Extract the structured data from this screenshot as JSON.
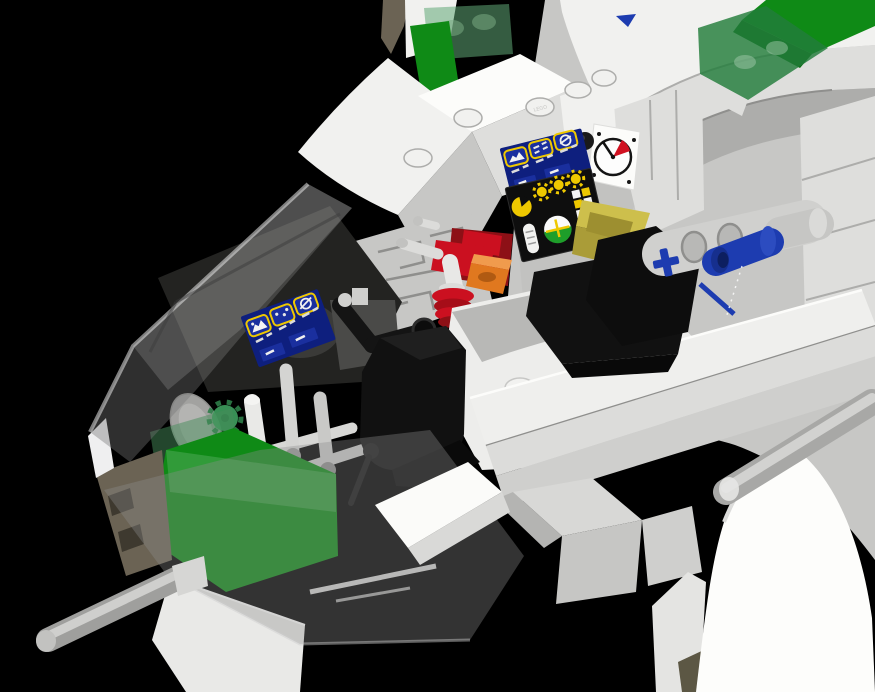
{
  "scene": {
    "subject": "lego-spaceship-cockpit-3d-render",
    "elements": [
      "nose-canopy",
      "pilot-seats",
      "control-panels",
      "instrument-stickers",
      "clock-gauge",
      "red-valve",
      "technic-pin",
      "antenna",
      "green-windscreen"
    ]
  },
  "studs": {
    "embossed_text": "LEGO"
  },
  "palette": {
    "bg": "#000000",
    "hullBright": "#fcfcfa",
    "hullWhite": "#f1f1ef",
    "hullLight": "#dededc",
    "hullMid": "#c7c7c5",
    "hullGray": "#adadab",
    "hullDark": "#8f8f8d",
    "hullDeep": "#6e6e6c",
    "interiorDark": "#232321",
    "seatBlack": "#111111",
    "seatEdge": "#2b2b2b",
    "greenSolid": "#0f8a16",
    "greenDark": "#0b6b12",
    "transGreen": "rgba(34,125,58,0.82)",
    "transGreenLight": "rgba(96,168,118,0.55)",
    "canopyVeil": "rgba(118,118,118,0.40)",
    "canopyVeilLight": "rgba(190,190,190,0.22)",
    "skirtVeil": "rgba(140,140,140,0.36)",
    "blue": "#1d3cb0",
    "blueDeep": "#12286e",
    "blueMuted": "#44549b",
    "red": "#cb1020",
    "redDark": "#8d1016",
    "orange": "#e0781f",
    "orangeLight": "#f09b4d",
    "yellowTan": "#cdbf4c",
    "yellowTanDark": "#aa9c38",
    "panelBlue": "#0e1f7e",
    "panelScreen": "#1a2f9e",
    "panelYellow": "#eec800",
    "stickerBlack": "#0e0e0e",
    "gaugeWhite": "#fdfdfd",
    "gaugeRed": "#d01020",
    "attitudeGreen": "#1e9e2a",
    "tanDark": "#6b6354",
    "oliveTan": "#5c5744",
    "pipeLight": "#dcdcda",
    "pipeMid": "#c2c2c0"
  }
}
